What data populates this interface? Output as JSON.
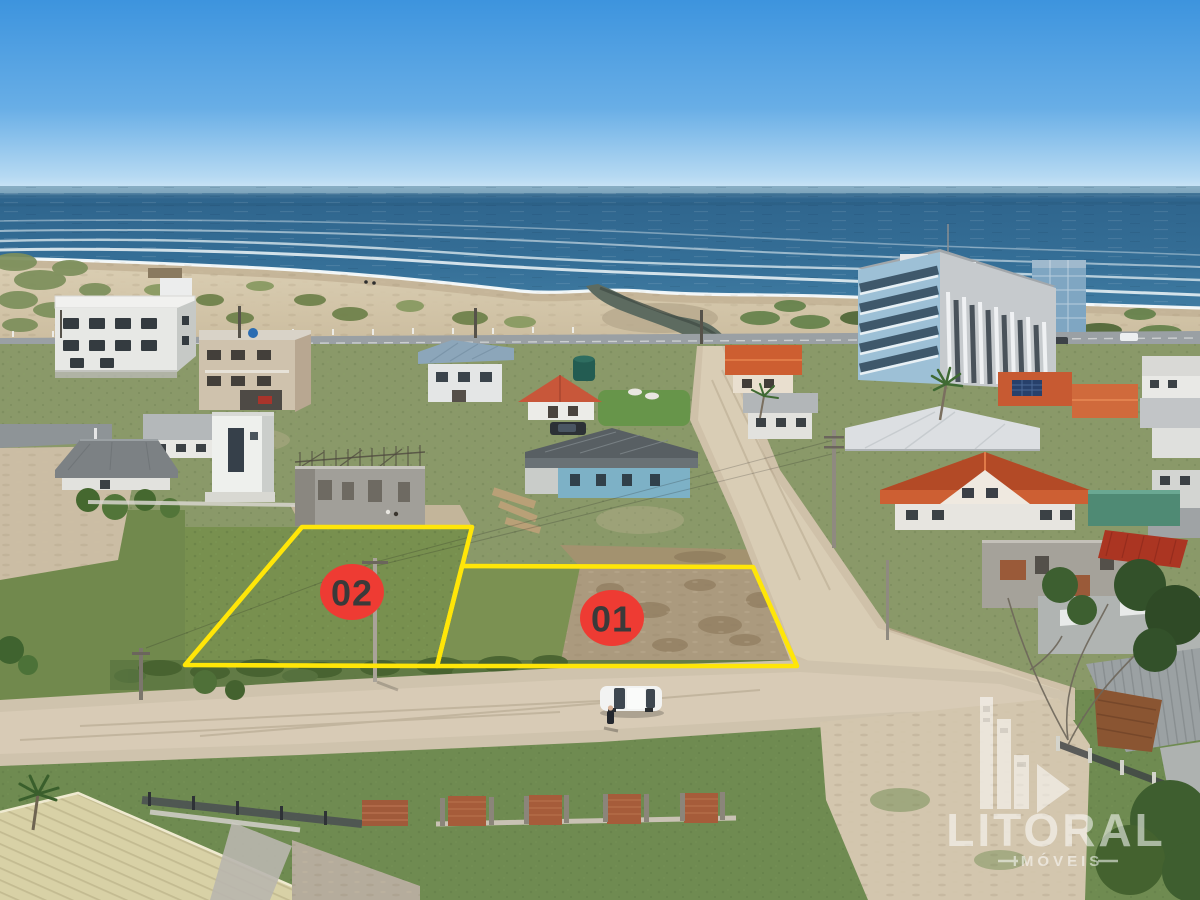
{
  "overlay": {
    "outline_color": "#FFE608",
    "badge_fill": "#EE3B33",
    "badge_text_color": "#3A3A3A",
    "lots": [
      {
        "id": "lot-01",
        "label": "01"
      },
      {
        "id": "lot-02",
        "label": "02"
      }
    ]
  },
  "watermark": {
    "brand": "LITORAL",
    "subtitle": "IMÓVEIS",
    "color": "#FFFFFF"
  }
}
